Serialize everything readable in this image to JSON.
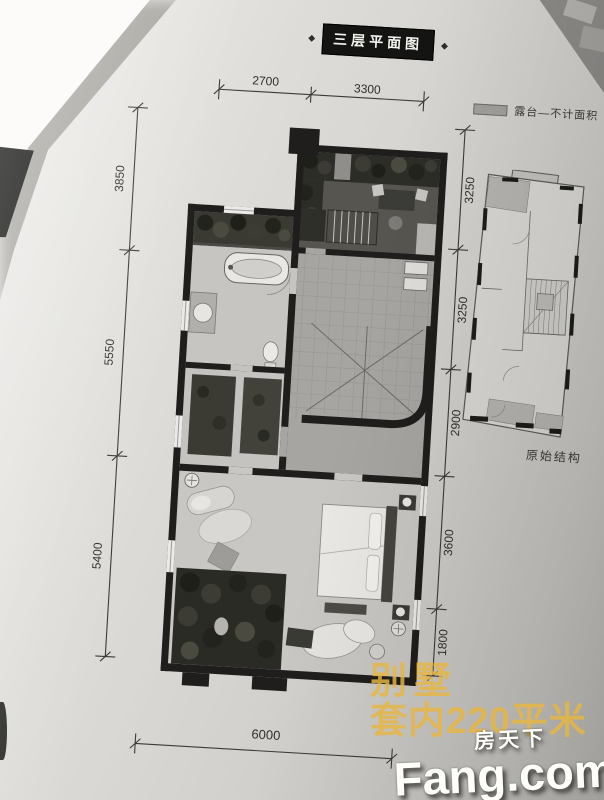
{
  "title": "三层平面图",
  "legend": {
    "label": "露台—不计面积",
    "swatch_color": "#a09f9b"
  },
  "dimensions": {
    "top": [
      "2700",
      "3300"
    ],
    "left": [
      "3850",
      "5550",
      "5400"
    ],
    "right": [
      "3250",
      "3250",
      "2900",
      "3600",
      "1800"
    ],
    "bottom": [
      "6000"
    ]
  },
  "secondary_plan": {
    "label": "原始结构"
  },
  "ad_text": {
    "line1": "别墅",
    "line2": "套内220平米",
    "color": "#e8b642"
  },
  "watermark": {
    "cn": "房天下",
    "en": "Fang.com"
  },
  "colors": {
    "wall": "#1f1e1c",
    "paper": "#deddd9",
    "foliage": "#2d2d27",
    "tile": "#a6a5a1"
  }
}
